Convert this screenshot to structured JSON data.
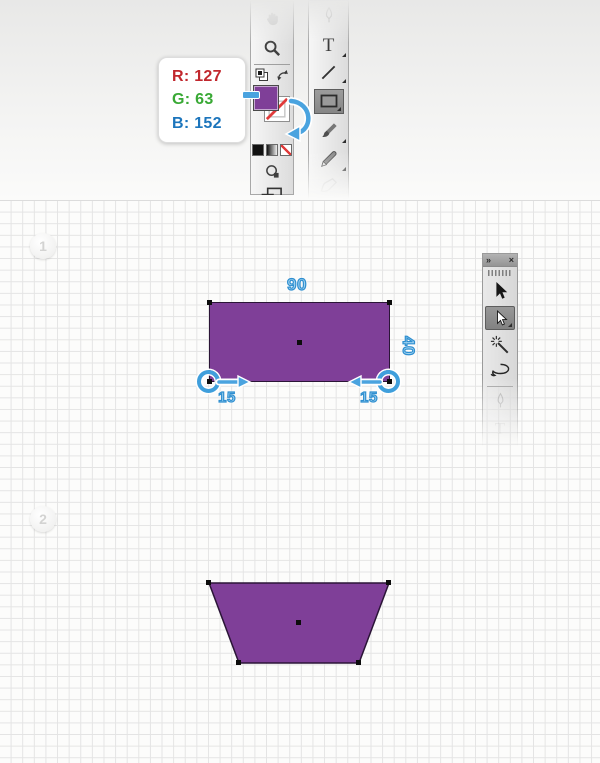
{
  "tooltip": {
    "r": "R: 127",
    "g": "G: 63",
    "b": "B: 152"
  },
  "colors": {
    "shape_fill": "#7F3F98",
    "shape_stroke": "#2B1537",
    "annotation_blue": "#29ABE2",
    "tooltip_red": "#C1272D",
    "tooltip_green": "#39A935",
    "tooltip_blue": "#1C75BC"
  },
  "toolbox_strip": {
    "tools": [
      "hand-tool",
      "zoom-tool",
      "default-fill-stroke",
      "swap-fill-stroke",
      "fill-color",
      "stroke-color",
      "color-mode",
      "gradient-mode",
      "none-mode",
      "drawing-mode",
      "screen-mode"
    ],
    "fill_color": "#7F3F98",
    "stroke": "none"
  },
  "tools_strip": {
    "type_label": "T",
    "tools": [
      "pen-tool",
      "type-tool",
      "line-segment-tool",
      "rectangle-tool",
      "paintbrush-tool",
      "pencil-tool",
      "blob-brush-tool"
    ],
    "selected_tool": "rectangle-tool"
  },
  "steps": {
    "step1": "1",
    "step2": "2"
  },
  "annotations": {
    "width": "90",
    "height": "40",
    "left_inset": "15",
    "right_inset": "15"
  },
  "tools_panel": {
    "expand_icon": "»",
    "close_icon": "×",
    "type_label": "T",
    "tools": [
      "selection-tool",
      "direct-selection-tool",
      "magic-wand-tool",
      "lasso-tool",
      "pen-tool",
      "type-tool"
    ],
    "selected_tool": "direct-selection-tool"
  }
}
